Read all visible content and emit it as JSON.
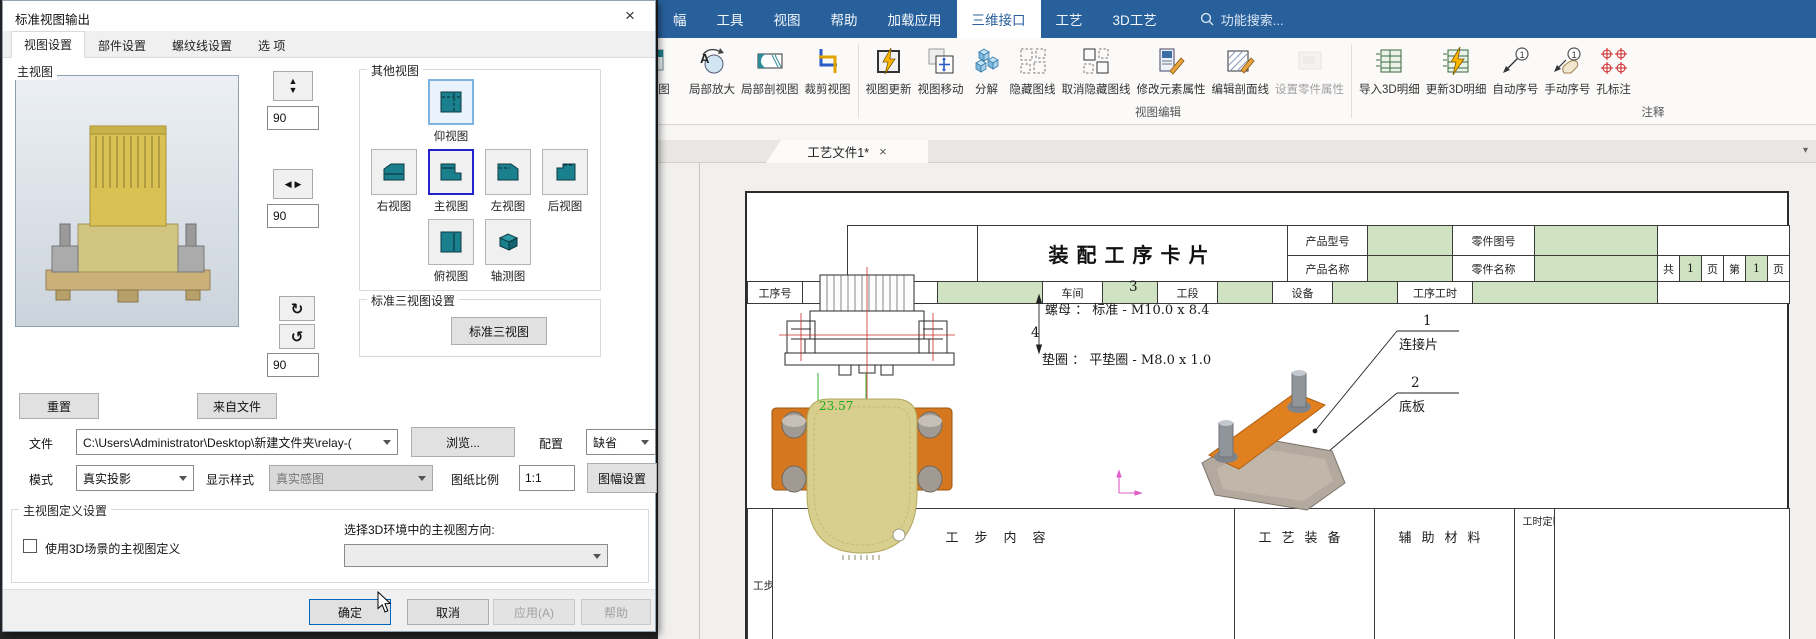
{
  "dialog": {
    "title": "标准视图输出",
    "close": "×",
    "tabs": [
      "视图设置",
      "部件设置",
      "螺纹线设置",
      "选 项"
    ],
    "main_view_label": "主视图",
    "reset": "重置",
    "from_file": "来自文件",
    "spin": {
      "v1": "90",
      "v2": "90",
      "v3": "90",
      "up": "▲",
      "down": "▼",
      "left": "◀",
      "right": "▶",
      "cw": "↻",
      "ccw": "↺"
    },
    "other_views": {
      "label": "其他视图",
      "bottom": "仰视图",
      "right": "右视图",
      "front": "主视图",
      "left": "左视图",
      "back": "后视图",
      "top": "俯视图",
      "iso": "轴测图"
    },
    "std3": {
      "label": "标准三视图设置",
      "button": "标准三视图"
    },
    "file_row": {
      "label": "文件",
      "path": "C:\\Users\\Administrator\\Desktop\\新建文件夹\\relay-(",
      "browse": "浏览...",
      "config_label": "配置",
      "config_value": "缺省"
    },
    "mode_row": {
      "label": "模式",
      "value": "真实投影",
      "style_label": "显示样式",
      "style_value": "真实感图",
      "scale_label": "图纸比例",
      "scale_value": "1:1",
      "sheet_button": "图幅设置"
    },
    "def_group": {
      "label": "主视图定义设置",
      "checkbox_label": "使用3D场景的主视图定义",
      "orient_label": "选择3D环境中的主视图方向:"
    },
    "footer": {
      "ok": "确定",
      "cancel": "取消",
      "apply": "应用(A)",
      "help": "帮助"
    }
  },
  "app": {
    "menu": {
      "items": [
        "幅",
        "工具",
        "视图",
        "帮助",
        "加载应用",
        "三维接口",
        "工艺",
        "3D工艺"
      ],
      "search": "功能搜索..."
    },
    "ribbon": {
      "items": [
        {
          "label": "图"
        },
        {
          "label": "局部放大"
        },
        {
          "label": "局部剖视图"
        },
        {
          "label": "裁剪视图"
        },
        {
          "label": "视图更新"
        },
        {
          "label": "视图移动"
        },
        {
          "label": "分解"
        },
        {
          "label": "隐藏图线"
        },
        {
          "label": "取消隐藏图线"
        },
        {
          "label": "修改元素属性"
        },
        {
          "label": "编辑剖面线"
        },
        {
          "label": "设置零件属性"
        },
        {
          "label": "导入3D明细"
        },
        {
          "label": "更新3D明细"
        },
        {
          "label": "自动序号"
        },
        {
          "label": "手动序号"
        },
        {
          "label": "孔标注"
        }
      ],
      "group_labels": [
        "视图编辑",
        "注释"
      ],
      "balloon_digit": "1",
      "zoom_letter": "A",
      "overflow": "▾"
    },
    "doc_tab": {
      "label": "工艺文件1*",
      "close": "×"
    }
  },
  "drawing": {
    "title": "装配工序卡片",
    "header": {
      "product_model": "产品型号",
      "part_drawing_no": "零件图号",
      "product_name": "产品名称",
      "part_name": "零件名称",
      "total": "共",
      "total_pages": "1",
      "pages_unit": "页",
      "page_no_label": "第",
      "page_no": "1",
      "page_unit": "页"
    },
    "process_row": {
      "c1": "工序号",
      "c2": "工序名称",
      "c3": "车间",
      "c4": "工段",
      "c5": "设备",
      "c6": "工序工时"
    },
    "bottom_row": {
      "c1": "工步号",
      "c2": "工步内容",
      "c3": "工艺装备",
      "c4": "辅助材料",
      "c5": "工时定额"
    },
    "annotations": {
      "n3": "3",
      "nut": "螺母 ： 标准 - M10.0 x 8.4",
      "n4": "4",
      "washer": "垫圈 ： 平垫圈 - M8.0 x 1.0",
      "n1": "1",
      "part1": "连接片",
      "n2": "2",
      "part2": "底板",
      "dim": "23.57"
    }
  },
  "colors": {
    "menu_blue": "#28609c",
    "selection_blue": "#2323cc",
    "table_green": "#cfe3c2",
    "dimension_green": "#1faa1f",
    "axis_pink": "#df5ec9",
    "view_icon_teal": "#1b808e",
    "part_orange": "#d4771f"
  }
}
